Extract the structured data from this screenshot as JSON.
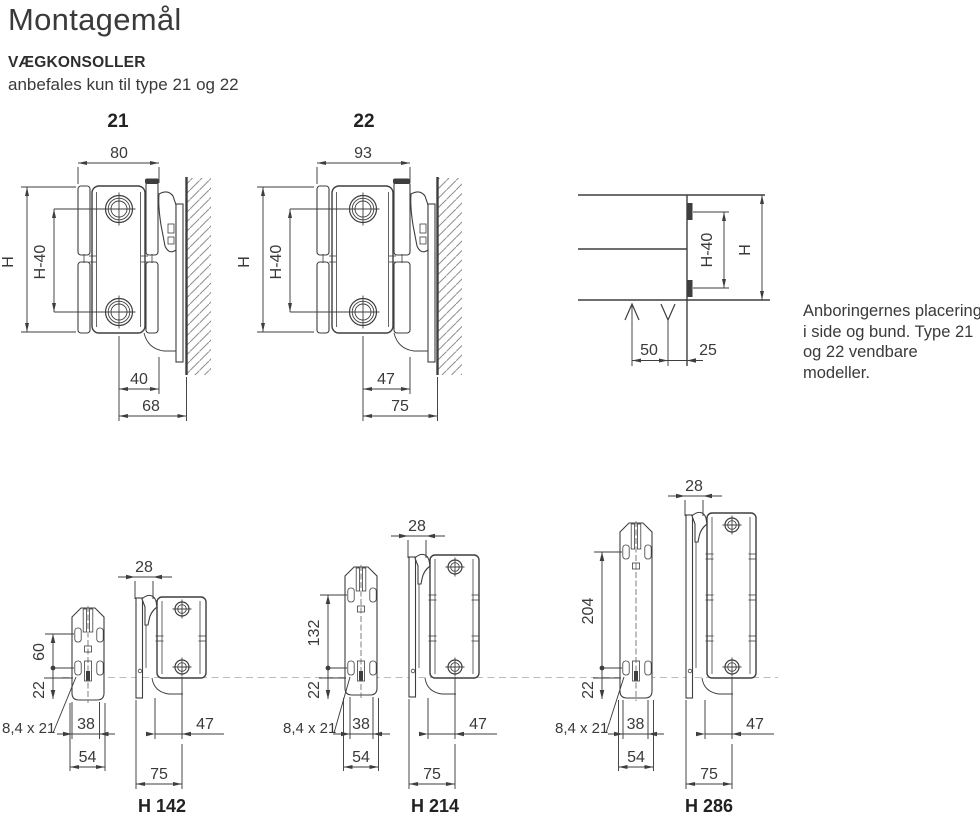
{
  "header": {
    "title": "Montagemål",
    "section": "VÆGKONSOLLER",
    "subtitle": "anbefales kun til type 21 og 22"
  },
  "note": {
    "line1": "Anboringernes placering",
    "line2": "i side og bund. Type 21",
    "line3": "og 22 vendbare modeller."
  },
  "type21": {
    "label": "21",
    "width": "80",
    "height": "H",
    "tapping_span": "H-40",
    "pipe_to_front": "40",
    "pipe_to_wall": "68"
  },
  "type22": {
    "label": "22",
    "width": "93",
    "height": "H",
    "tapping_span": "H-40",
    "pipe_to_front": "47",
    "pipe_to_wall": "75"
  },
  "end_view": {
    "height": "H",
    "tapping_span": "H-40",
    "inlet_offset": "50",
    "outlet_offset": "25"
  },
  "brackets": {
    "h142": {
      "label": "H 142",
      "top_depth": "28",
      "hole_span": "60",
      "bottom_offset": "22",
      "slot_size": "8,4 x 21",
      "hole_width": "38",
      "bracket_width": "54",
      "front_depth": "47",
      "total_depth": "75"
    },
    "h214": {
      "label": "H 214",
      "top_depth": "28",
      "hole_span": "132",
      "bottom_offset": "22",
      "slot_size": "8,4 x 21",
      "hole_width": "38",
      "bracket_width": "54",
      "front_depth": "47",
      "total_depth": "75"
    },
    "h286": {
      "label": "H 286",
      "top_depth": "28",
      "hole_span": "204",
      "bottom_offset": "22",
      "slot_size": "8,4 x 21",
      "hole_width": "38",
      "bracket_width": "54",
      "front_depth": "47",
      "total_depth": "75"
    }
  }
}
